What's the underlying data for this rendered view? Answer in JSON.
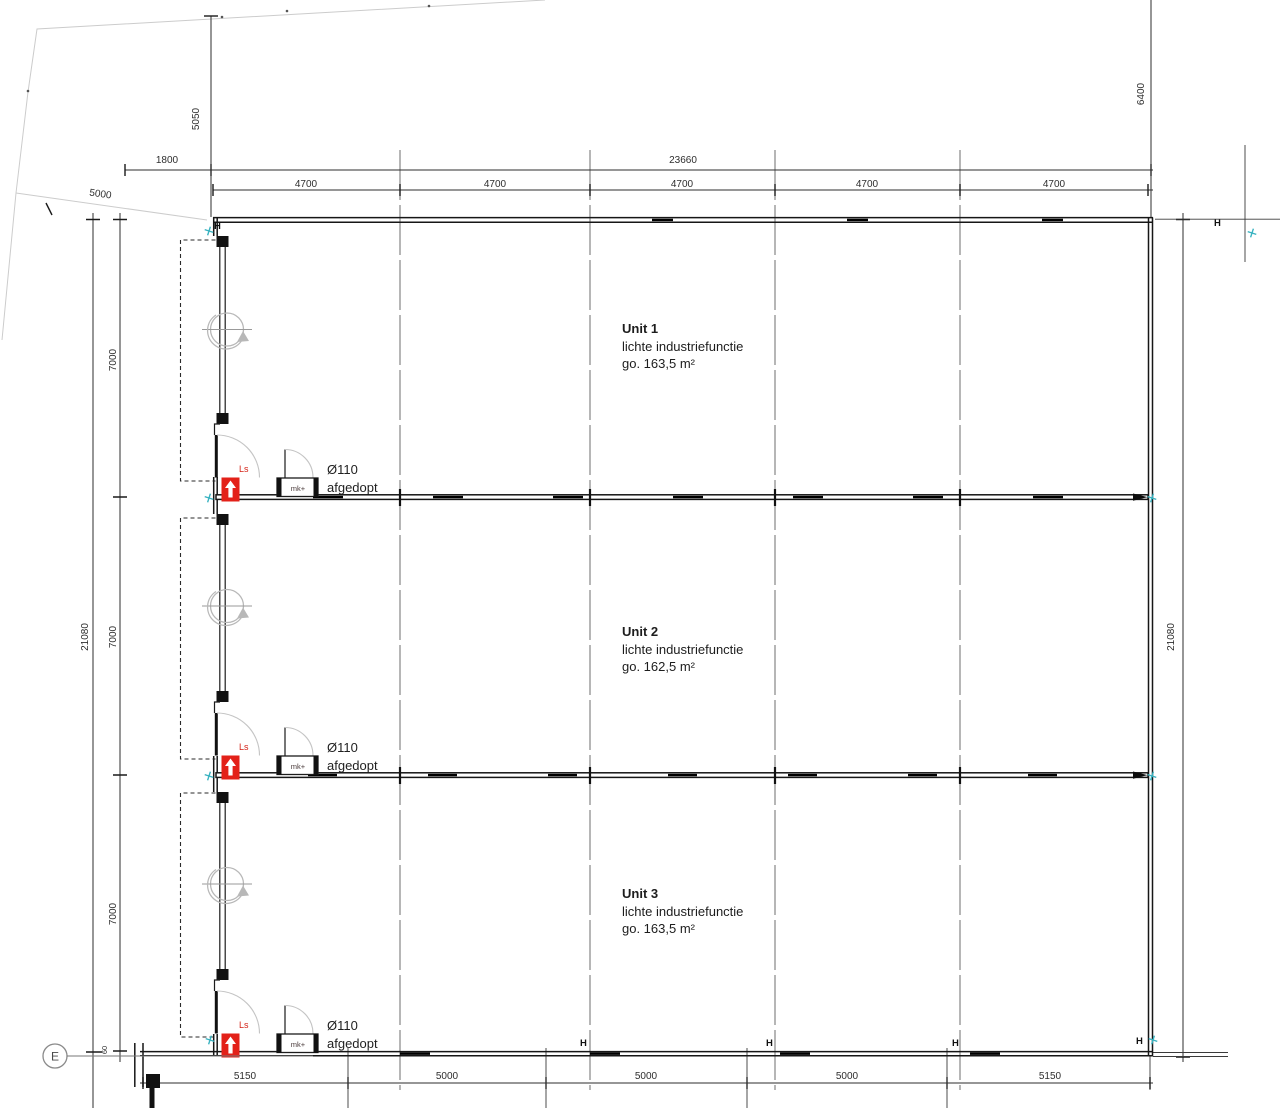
{
  "drawing": {
    "grid": {
      "row_label": "E",
      "column_symbol": "H"
    },
    "units": [
      {
        "name": "Unit 1",
        "function_label": "lichte industriefunctie",
        "area_label": "go. 163,5 m²",
        "stair_label": "Ls",
        "closet_label": "mk+",
        "pipe_label": "Ø110",
        "pipe_note": "afgedopt"
      },
      {
        "name": "Unit 2",
        "function_label": "lichte industriefunctie",
        "area_label": "go. 162,5 m²",
        "stair_label": "Ls",
        "closet_label": "mk+",
        "pipe_label": "Ø110",
        "pipe_note": "afgedopt"
      },
      {
        "name": "Unit 3",
        "function_label": "lichte industriefunctie",
        "area_label": "go. 163,5 m²",
        "stair_label": "Ls",
        "closet_label": "mk+",
        "pipe_label": "Ø110",
        "pipe_note": "afgedopt"
      }
    ],
    "dims": {
      "top_offset": "1800",
      "top_total": "23660",
      "top_bays": [
        "4700",
        "4700",
        "4700",
        "4700",
        "4700"
      ],
      "left_setback": "5050",
      "right_setback": "6400",
      "site_diagonal": "5000",
      "left_total": "21080",
      "left_segments": [
        "7000",
        "7000",
        "7000"
      ],
      "right_total": "21080",
      "bottom_bays": [
        "5150",
        "5000",
        "5000",
        "5000",
        "5150"
      ],
      "grid_offset": "60"
    },
    "colors": {
      "exit_red": "#e32119",
      "marker_cyan": "#38b2c0",
      "wall_line": "#161616",
      "dim_line": "#2e2e2e"
    }
  }
}
